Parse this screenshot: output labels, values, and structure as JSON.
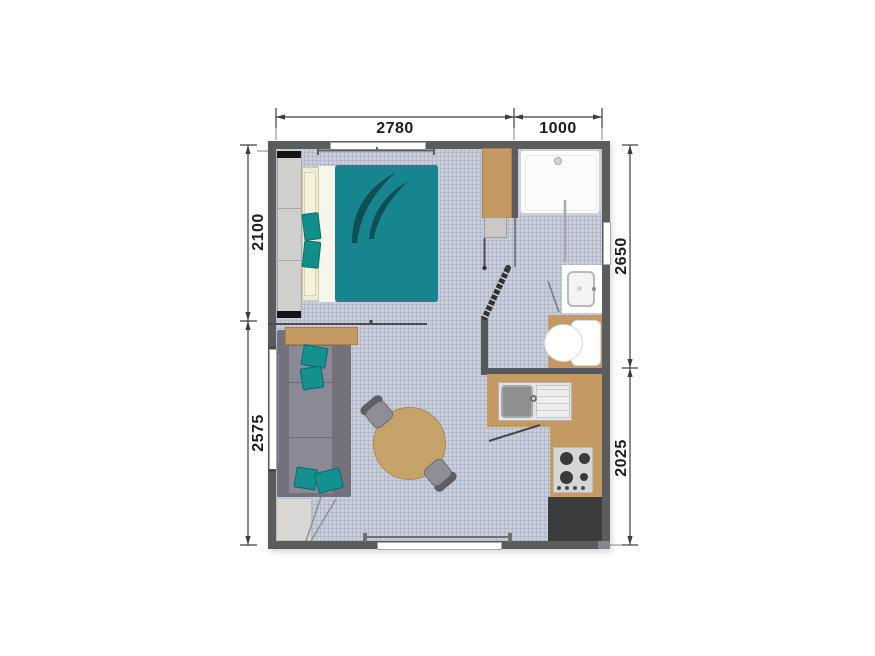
{
  "drawing": {
    "type": "mobile-home floor plan, top view",
    "background": "#ffffff"
  },
  "dimensions_mm": {
    "top": [
      {
        "value": "2780"
      },
      {
        "value": "1000"
      }
    ],
    "left": [
      {
        "value": "2100"
      },
      {
        "value": "2575"
      }
    ],
    "right": [
      {
        "value": "2650"
      },
      {
        "value": "2025"
      }
    ]
  },
  "colors": {
    "wall": "#5a5c5e",
    "floor": "#c9ceda",
    "accent_teal": "#17858d",
    "accent_teal_dark": "#0e4e57",
    "wood_tan": "#c49a62",
    "sofa_gray": "#74717d",
    "dark_counter": "#3b3c3e",
    "fixture_white": "#fcfcfc"
  },
  "furniture": [
    {
      "id": "wardrobe"
    },
    {
      "id": "double-bed"
    },
    {
      "id": "pillows"
    },
    {
      "id": "duvet"
    },
    {
      "id": "curtain-rail"
    },
    {
      "id": "bedroom-window"
    },
    {
      "id": "storage-cabinet"
    },
    {
      "id": "shower-tray"
    },
    {
      "id": "shower-screen"
    },
    {
      "id": "bathroom-shelf"
    },
    {
      "id": "bathroom-door"
    },
    {
      "id": "washbasin"
    },
    {
      "id": "toilet"
    },
    {
      "id": "kitchen-worktop"
    },
    {
      "id": "kitchen-sink"
    },
    {
      "id": "cooktop"
    },
    {
      "id": "dark-base-cabinet"
    },
    {
      "id": "sofa"
    },
    {
      "id": "side-shelf"
    },
    {
      "id": "scatter-cushions"
    },
    {
      "id": "dining-table"
    },
    {
      "id": "dining-chairs"
    },
    {
      "id": "entrance-mat"
    },
    {
      "id": "entrance-door"
    },
    {
      "id": "patio-window"
    },
    {
      "id": "side-window"
    },
    {
      "id": "bathroom-window"
    }
  ]
}
